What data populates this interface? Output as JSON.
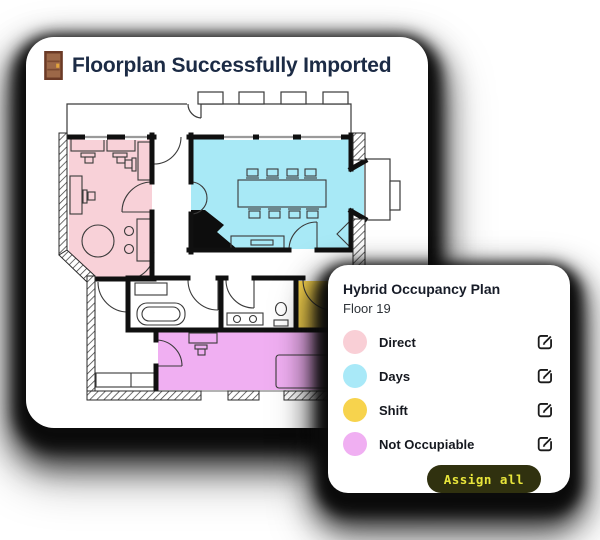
{
  "main_card": {
    "title": "Floorplan Successfully Imported",
    "title_color": "#1C2B45",
    "icon": "door-icon"
  },
  "panel": {
    "title": "Hybrid Occupancy Plan",
    "subtitle": "Floor 19",
    "legend": [
      {
        "label": "Direct",
        "color": "#F9CFD6"
      },
      {
        "label": "Days",
        "color": "#A9E9F8"
      },
      {
        "label": "Shift",
        "color": "#F7D34D"
      },
      {
        "label": "Not Occupiable",
        "color": "#F0AFF2"
      }
    ],
    "edit_icon": "pencil-square-icon",
    "button": {
      "label": "Assign all",
      "bg": "#30310F",
      "text_color": "#E8E53B"
    }
  },
  "floorplan": {
    "room_colors": {
      "direct": "#F8D1D8",
      "days": "#A8E9F6",
      "shift": "#F7D34D",
      "not_occupiable": "#F0AFF2"
    },
    "wall_color": "#101010",
    "hatch_color": "#3f3f3f"
  }
}
